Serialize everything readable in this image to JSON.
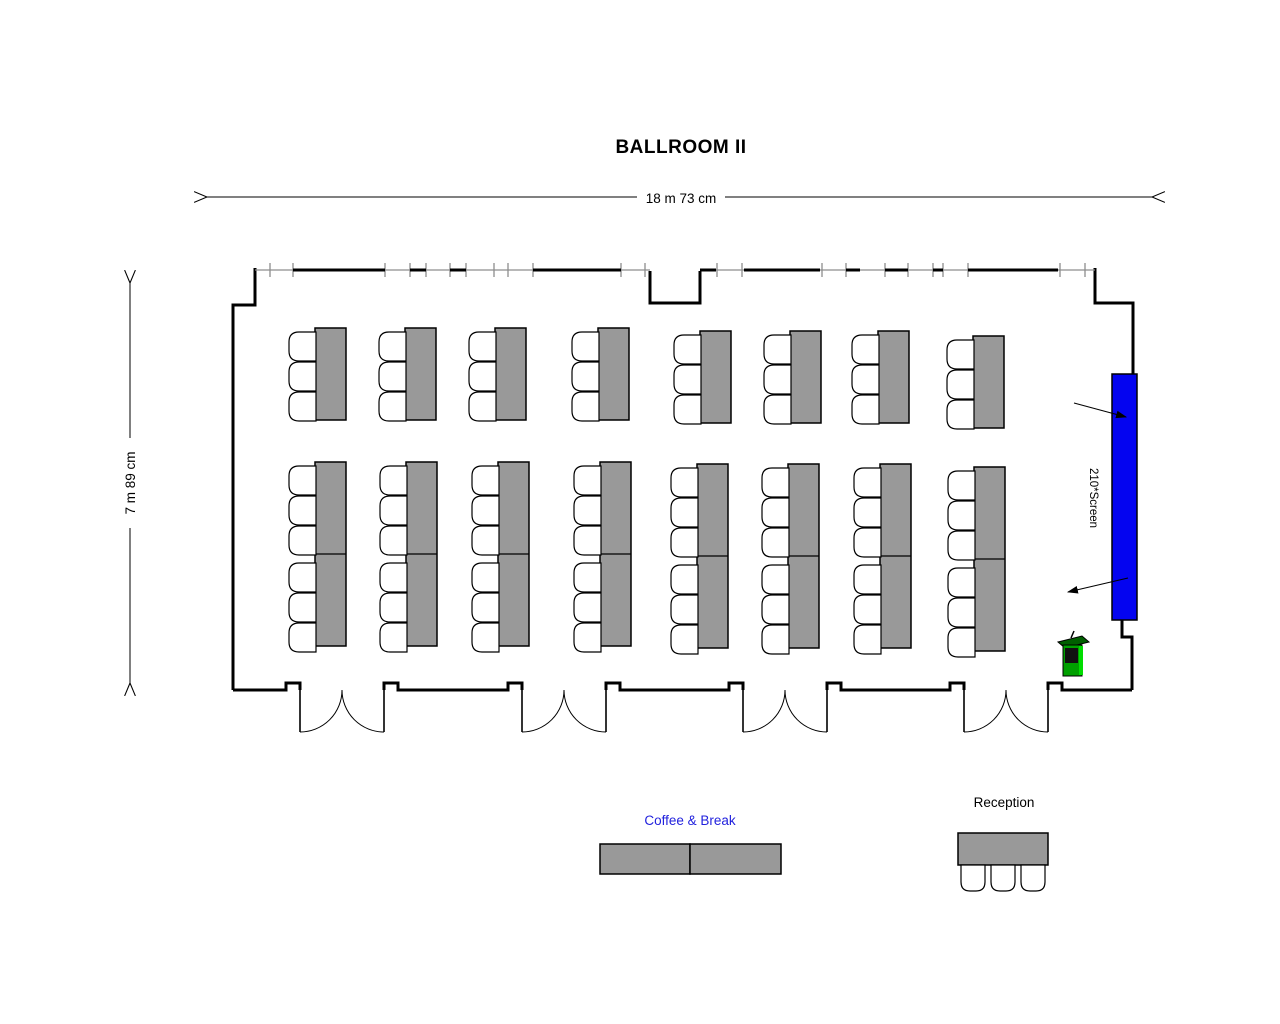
{
  "title": "BALLROOM II",
  "dimensions": {
    "width_label": "18 m 73 cm",
    "height_label": "7 m 89 cm"
  },
  "screen": {
    "label": "210*Screen"
  },
  "areas": {
    "coffee_label": "Coffee & Break",
    "reception_label": "Reception"
  },
  "colors": {
    "table_fill": "#999999",
    "screen_fill": "#0404f0",
    "podium_body": "#00a000",
    "podium_top": "#005f00",
    "podium_highlight": "#00dd00",
    "coffee_label_color": "#2222dd",
    "wall": "#000000",
    "window": "#8d8d8d"
  },
  "furniture": {
    "top_row": {
      "tables": 8,
      "chairs_per_table": 3,
      "chair_side": "left"
    },
    "middle_row": {
      "tables": 8,
      "segments_per_table": 2,
      "chairs_per_table": 6,
      "chair_side": "left"
    },
    "coffee_table_segments": 2,
    "reception": {
      "tables": 1,
      "chairs": 3,
      "chair_side": "bottom"
    },
    "doors": 4,
    "podium": 1
  }
}
